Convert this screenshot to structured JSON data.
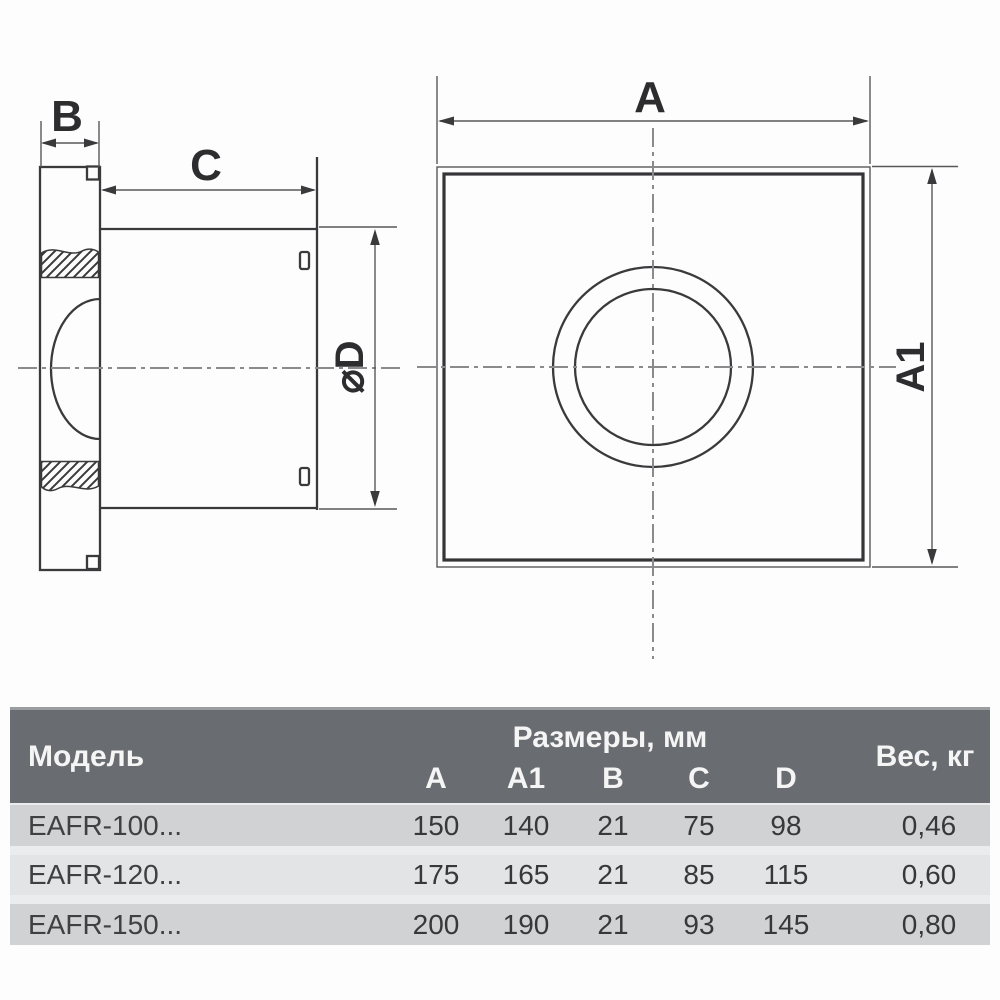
{
  "drawing": {
    "side_view": {
      "label_b": "B",
      "label_c": "C",
      "label_d": "⌀D"
    },
    "front_view": {
      "label_a": "A",
      "label_a1": "A1"
    }
  },
  "table": {
    "header": {
      "model": "Модель",
      "dims_group": "Размеры, мм",
      "weight": "Вес, кг",
      "cols": [
        "A",
        "A1",
        "B",
        "C",
        "D"
      ]
    },
    "rows": [
      {
        "model": "EAFR-100...",
        "values": [
          "150",
          "140",
          "21",
          "75",
          "98"
        ],
        "weight": "0,46"
      },
      {
        "model": "EAFR-120...",
        "values": [
          "175",
          "165",
          "21",
          "85",
          "115"
        ],
        "weight": "0,60"
      },
      {
        "model": "EAFR-150...",
        "values": [
          "200",
          "190",
          "21",
          "93",
          "145"
        ],
        "weight": "0,80"
      }
    ]
  },
  "colors": {
    "header_bg": "#696c70",
    "header_text": "#f5f5f5",
    "row_bg": "#d1d2d4",
    "row_alt_bg": "#e3e4e6",
    "row_gap": "#ebeced",
    "drawing_line": "#3a3a3c",
    "centerline": "#8b8b8d",
    "text": "#37383a"
  }
}
